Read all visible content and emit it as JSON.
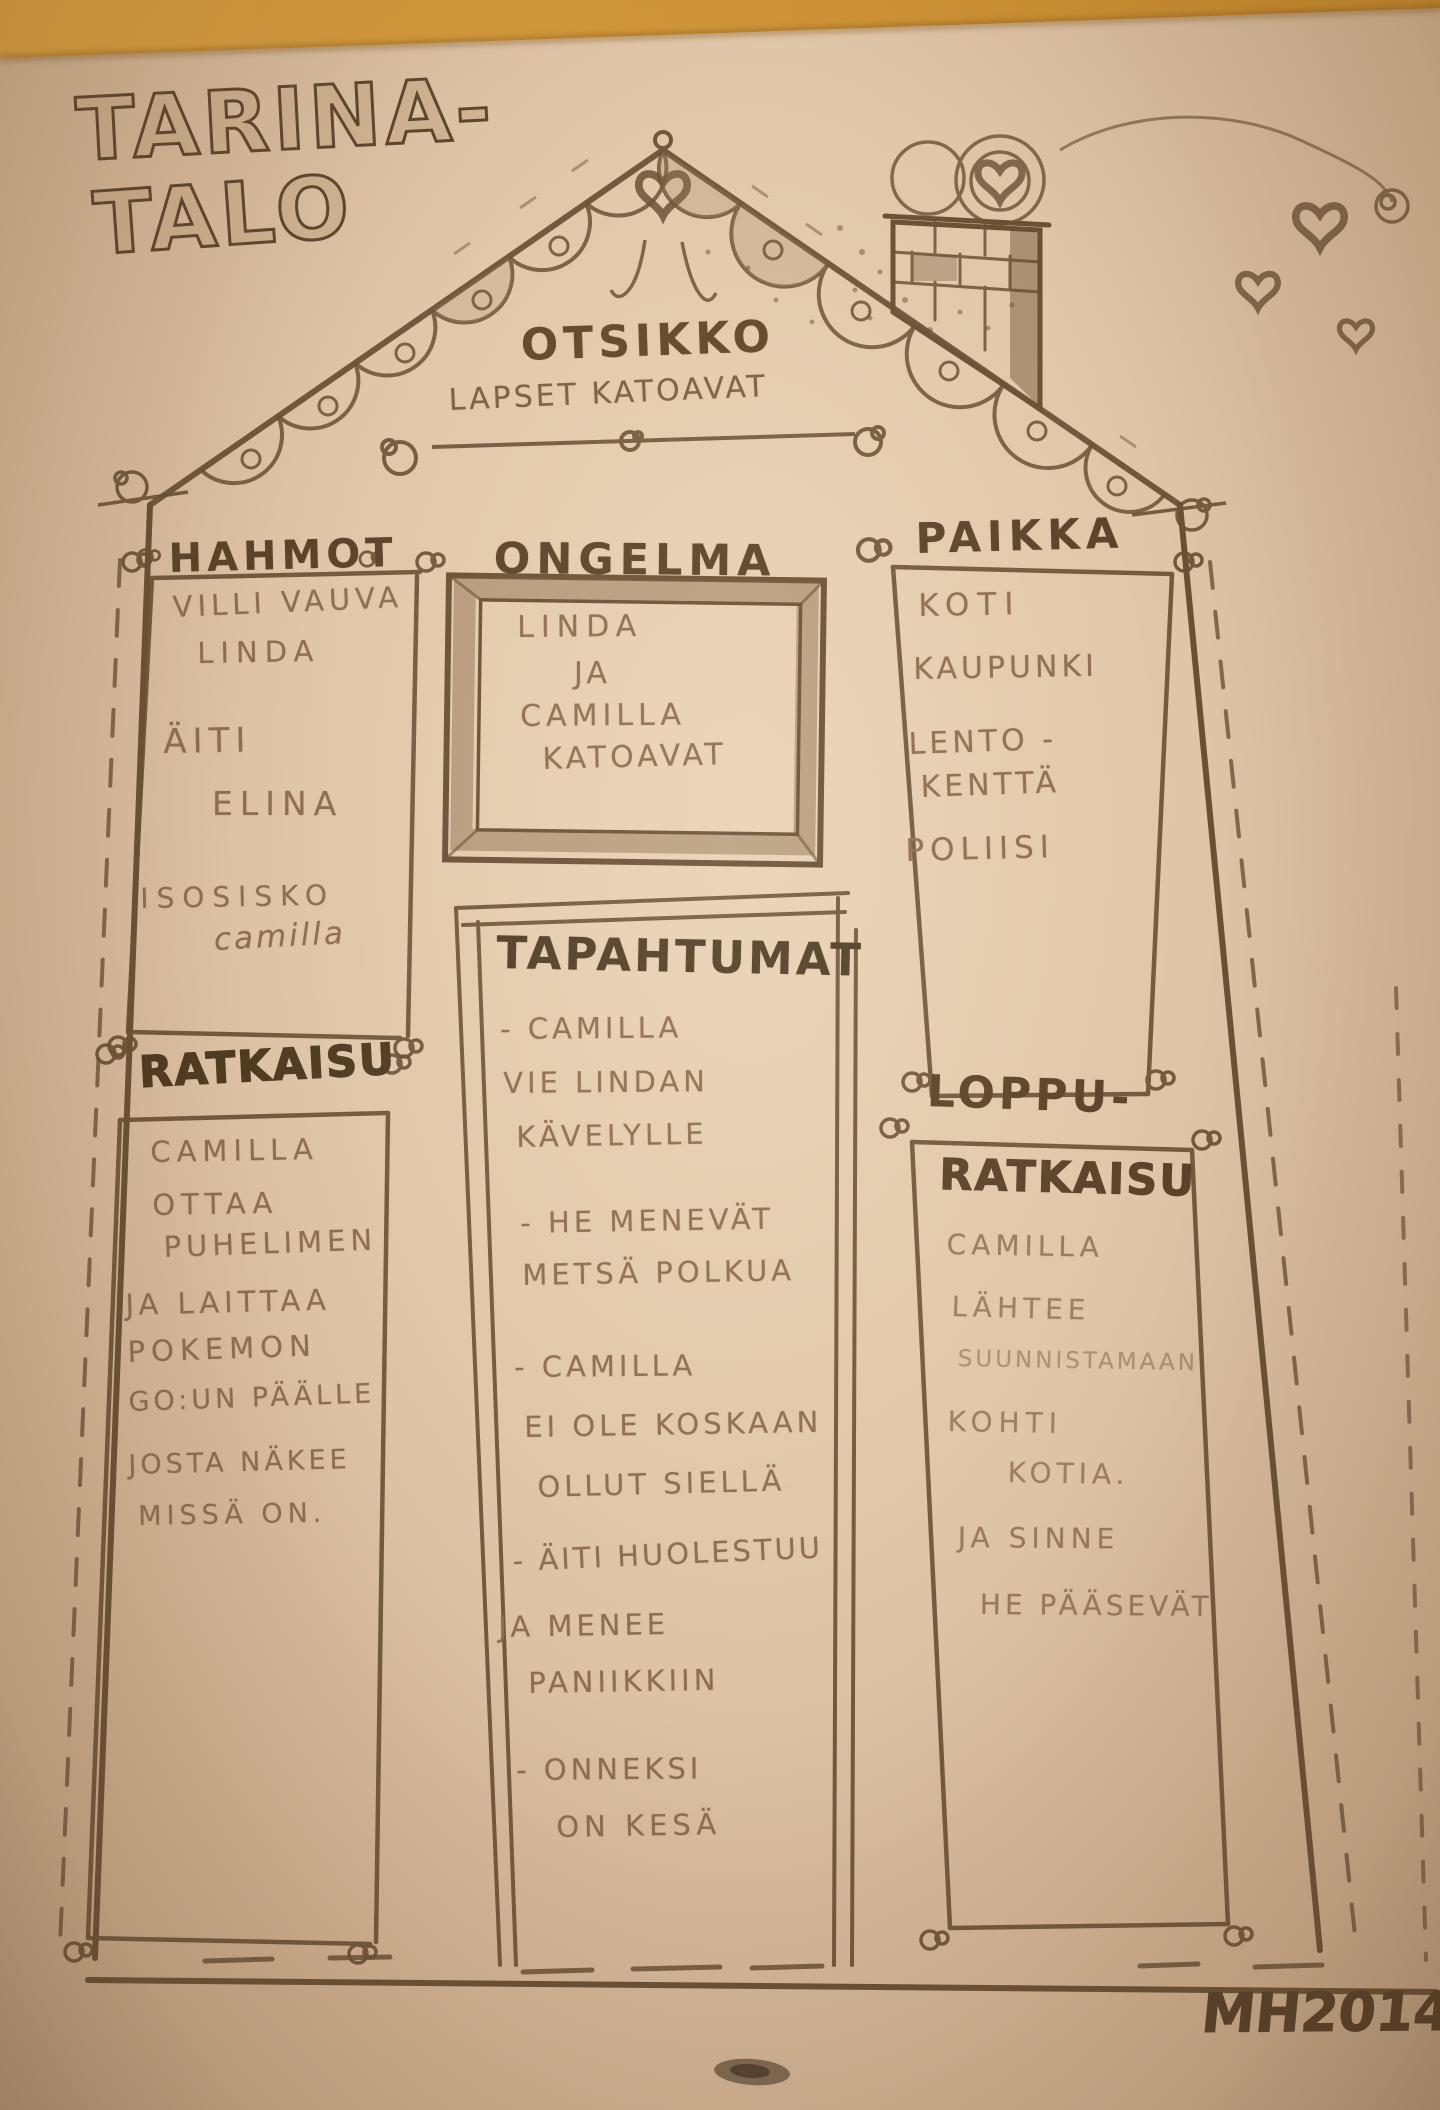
{
  "photo": {
    "description": "hand-drawn story-house worksheet on paper, photographed on a wooden table",
    "table_color": "#cd9134",
    "paper_color": "#e0c6a8",
    "ink_color": "#6a5136",
    "pencil_color": "#8d6e4f"
  },
  "title": {
    "line1": "TARINA-",
    "line2": "TALO"
  },
  "roof": {
    "label": "OTSIKKO",
    "story_title": "LAPSET KATOAVAT"
  },
  "sections": {
    "hahmot": {
      "heading": "HAHMOT",
      "items": [
        "VILLI VAUVA",
        "LINDA",
        "ÄITI",
        "ELINA",
        "ISOSISKO",
        "camilla"
      ]
    },
    "ongelma": {
      "heading": "ONGELMA",
      "lines": [
        "LINDA",
        "JA",
        "CAMILLA",
        "KATOAVAT"
      ]
    },
    "paikka": {
      "heading": "PAIKKA",
      "items": [
        "KOTI",
        "KAUPUNKI",
        "LENTO -",
        "KENTTÄ",
        "POLIISI"
      ]
    },
    "ratkaisu": {
      "heading": "RATKAISU",
      "lines": [
        "CAMILLA",
        "OTTAA",
        "PUHELIMEN",
        "JA LAITTAA",
        "POKEMON",
        "GO:UN PÄÄLLE",
        "JOSTA NÄKEE",
        "MISSÄ ON."
      ]
    },
    "tapahtumat": {
      "heading": "TAPAHTUMAT",
      "lines": [
        "- CAMILLA",
        "VIE LINDAN",
        "KÄVELYLLE",
        "- HE MENEVÄT",
        "METSÄ POLKUA",
        "- CAMILLA",
        "EI OLE KOSKAAN",
        "OLLUT SIELLÄ",
        "- ÄITI HUOLESTUU",
        "JA MENEE",
        "PANIIKKIIN",
        "- ONNEKSI",
        "ON KESÄ"
      ]
    },
    "loppuratkaisu": {
      "heading_line1": "LOPPU-",
      "heading_line2": "RATKAISU",
      "lines": [
        "CAMILLA",
        "LÄHTEE",
        "SUUNNISTAMAAN",
        "KOHTI",
        "KOTIA.",
        "JA SINNE",
        "HE PÄÄSEVÄT"
      ]
    }
  },
  "signature": "MH2014"
}
